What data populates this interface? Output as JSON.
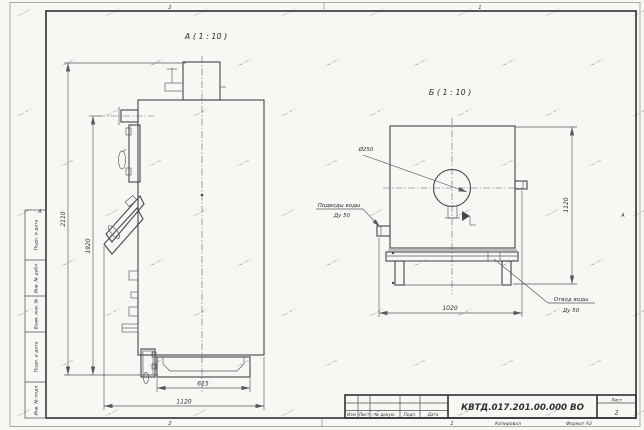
{
  "drawing": {
    "view_a": {
      "label": "А ( 1 : 10 )",
      "dim_total_height": "2110",
      "dim_outlet_height": "1920",
      "dim_base": "615",
      "dim_depth": "1120"
    },
    "view_b": {
      "label": "Б ( 1 : 10 )",
      "chimney_dia": "Ø250",
      "dim_width": "1020",
      "dim_height": "1120",
      "inlet_label": "Подводы воды",
      "inlet_size": "Ду 50",
      "outlet_label": "Отвод воды",
      "outlet_size": "Ду 50"
    },
    "frame": {
      "zone_top_left": "2",
      "zone_top_right": "1",
      "zone_bottom_left": "2",
      "zone_bottom_right": "1",
      "zone_left": "А",
      "zone_right": "А",
      "stamp_fields": [
        "Подп. и дата",
        "Инв. № дубл.",
        "Взам. инв. №",
        "Подп. и дата",
        "Инв. № подл."
      ]
    },
    "title_block": {
      "doc_number": "КВТД.017.201.00.000 ВО",
      "sheet_label": "Лист",
      "sheet_number": "2",
      "col_izm": "Изм",
      "col_list": "Лист",
      "col_doc": "№ докум.",
      "col_podp": "Подп.",
      "col_data": "Дата",
      "footer_copy": "Копировал",
      "footer_format": "Формат А3"
    }
  },
  "watermark": {
    "glyph": "·~·~·",
    "cols": 8,
    "rows": 9,
    "stepx": 88,
    "stepy": 50
  }
}
